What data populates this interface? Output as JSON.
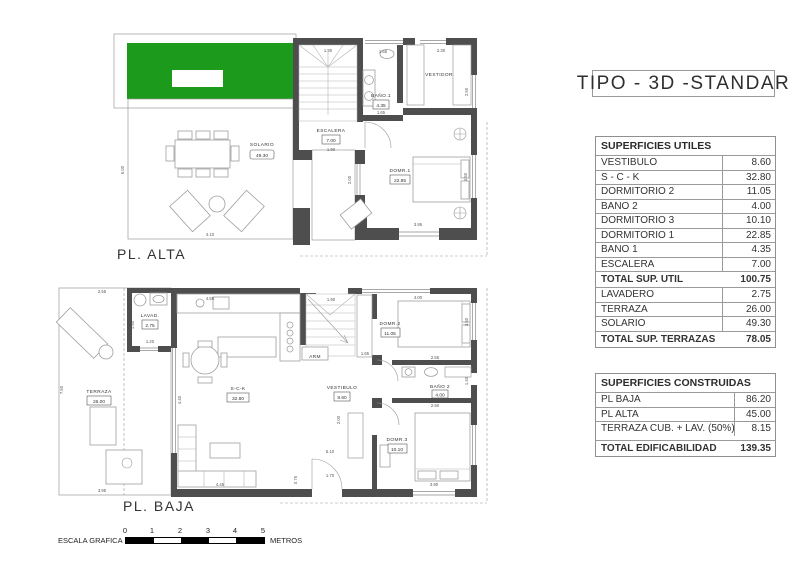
{
  "title": "TIPO - 3D -STANDAR",
  "plan_alta": {
    "label": "PL. ALTA",
    "rooms": {
      "solario": {
        "name": "SOLARIO",
        "area": "49.30"
      },
      "escalera": {
        "name": "ESCALERA",
        "area": "7.00"
      },
      "bano1": {
        "name": "BAÑO.1",
        "area": "4.35"
      },
      "vestidor": {
        "name": "VESTIDOR"
      },
      "dorm1": {
        "name": "DOMR.1",
        "area": "22.85"
      }
    },
    "dims": {
      "stair_top": "1.90",
      "bano_top": "1.65",
      "vestidor_top": "2.30",
      "solario_left": "6.00",
      "solario_bottom": "4.10",
      "stair_bottom": "1.90",
      "bano_bottom": "1.65",
      "dorm_window": "3.95",
      "dorm_right": "4.50",
      "dorm_left": "2.00",
      "vestidor_right": "2.50"
    }
  },
  "plan_baja": {
    "label": "PL. BAJA",
    "rooms": {
      "terraza": {
        "name": "TERRAZA",
        "area": "26.00"
      },
      "lavad": {
        "name": "LAVAD.",
        "area": "2.75"
      },
      "sck": {
        "name": "S-C-K",
        "area": "32.80"
      },
      "vestibulo": {
        "name": "VESTIBULO",
        "area": "8.60"
      },
      "arm": {
        "name": "ARM"
      },
      "dorm2": {
        "name": "DOMR.2",
        "area": "11.05"
      },
      "bano2": {
        "name": "BAÑO 2",
        "area": "4.00"
      },
      "dorm3": {
        "name": "DOMR.3",
        "area": "10.10"
      }
    },
    "dims": {
      "terraza_top": "2.55",
      "terraza_left": "7.50",
      "terraza_bottom": "3.95",
      "lavad_left": "1.50",
      "lavad_bottom": "1.20",
      "kitchen_top": "4.55",
      "stair_top": "1.90",
      "dorm2_top": "4.00",
      "dorm2_right": "3.50",
      "dorm2_door": "1.65",
      "bano2_top": "2.55",
      "bano2_bottom": "2.50",
      "bano2_right": "1.40",
      "sck_left": "4.40",
      "sck_bottom": "4.45",
      "entry": "0.75",
      "hall_a": "5.10",
      "hall_b": "1.70",
      "dorm3_bottom": "3.90",
      "hall_c": "2.00"
    }
  },
  "colors": {
    "grass": "#1b9a1b",
    "wall": "#4e4e4e"
  },
  "tables": {
    "utiles": {
      "header": "SUPERFICIES UTILES",
      "rows": [
        {
          "label": "VESTIBULO",
          "value": "8.60"
        },
        {
          "label": "S - C - K",
          "value": "32.80"
        },
        {
          "label": "DORMITORIO 2",
          "value": "11.05"
        },
        {
          "label": "BAÑO 2",
          "value": "4.00"
        },
        {
          "label": "DORMITORIO 3",
          "value": "10.10"
        },
        {
          "label": "DORMITORIO 1",
          "value": "22.85"
        },
        {
          "label": "BAÑO 1",
          "value": "4.35"
        },
        {
          "label": "ESCALERA",
          "value": "7.00"
        },
        {
          "label": "TOTAL SUP. UTIL",
          "value": "100.75",
          "total": true
        },
        {
          "label": "LAVADERO",
          "value": "2.75"
        },
        {
          "label": "TERRAZA",
          "value": "26.00"
        },
        {
          "label": "SOLARIO",
          "value": "49.30"
        },
        {
          "label": "TOTAL SUP. TERRAZAS",
          "value": "78.05",
          "total": true
        }
      ]
    },
    "construidas": {
      "header": "SUPERFICIES CONSTRUIDAS",
      "rows": [
        {
          "label": "PL BAJA",
          "value": "86.20"
        },
        {
          "label": "PL ALTA",
          "value": "45.00"
        },
        {
          "label": "TERRAZA CUB. + LAV. (50%)",
          "value": "8.15"
        },
        {
          "label": "TOTAL EDIFICABILIDAD",
          "value": "139.35",
          "total": true,
          "gap": true
        }
      ]
    }
  },
  "scale_bar": {
    "label": "ESCALA GRAFICA :",
    "ticks": [
      "0",
      "1",
      "2",
      "3",
      "4",
      "5"
    ],
    "unit": "METROS"
  }
}
